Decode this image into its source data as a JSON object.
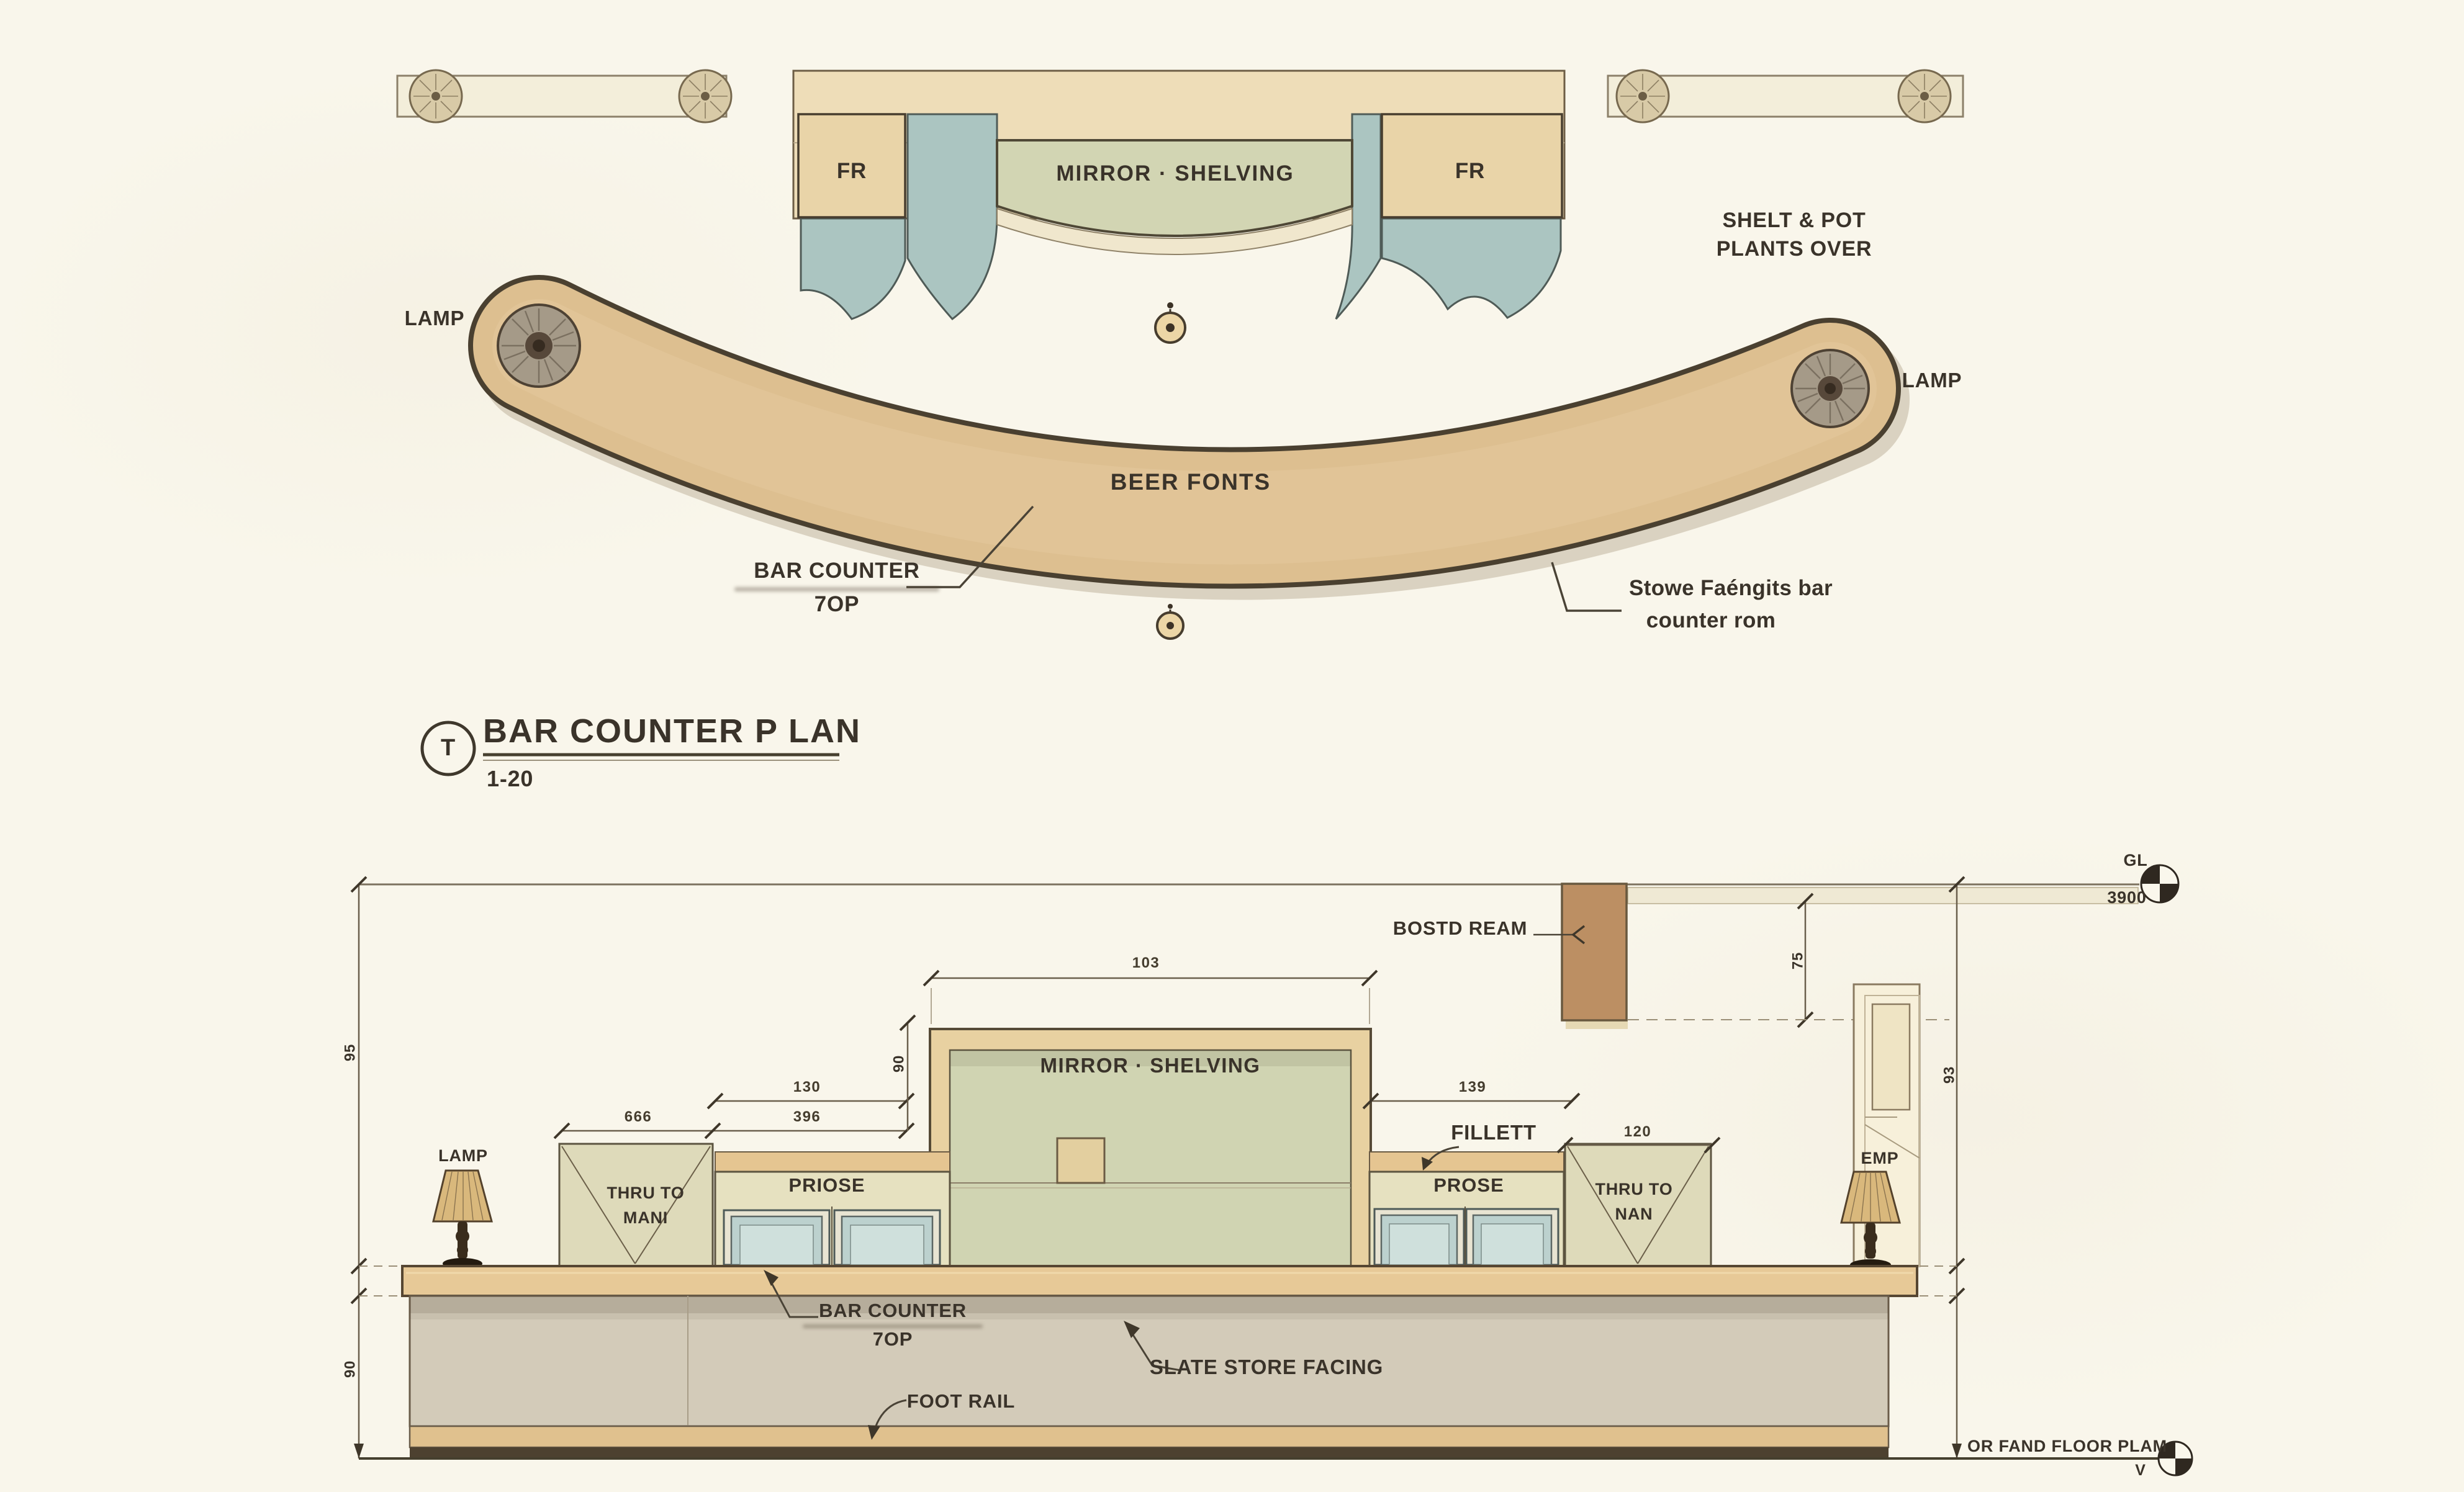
{
  "plan": {
    "fr_left": "FR",
    "fr_right": "FR",
    "mirror_shelving": "MIRROR · SHELVING",
    "shelf_note_line1": "SHELT & POT",
    "shelf_note_line2": "PLANTS OVER",
    "lamp_left": "LAMP",
    "lamp_right": "LAMP",
    "beer_fonts": "BEER FONTS",
    "counter_label_line1": "BAR COUNTER",
    "counter_label_line2": "7OP",
    "note_line1": "Stowe Faéngits bar",
    "note_line2": "counter rom",
    "title": {
      "marker": "T",
      "text": "BAR COUNTER P LAN",
      "scale": "1-20"
    }
  },
  "elevation": {
    "beam_label": "BOSTD REAM",
    "datum_top": {
      "label": "GL",
      "value": "3900"
    },
    "mirror_shelving": "MIRROR · SHELVING",
    "fillett": "FILLETT",
    "cabinet_left": "PRIOSE",
    "cabinet_right": "PROSE",
    "thru_left_line1": "THRU TO",
    "thru_left_line2": "MANI",
    "thru_right_line1": "THRU TO",
    "thru_right_line2": "NAN",
    "lamp_left": "LAMP",
    "lamp_right": "EMP",
    "counter_label_line1": "BAR COUNTER",
    "counter_label_line2": "7OP",
    "slate_label": "SLATE STORE FACING",
    "foot_rail_label": "FOOT RAIL",
    "floor_label": "OR FAND FLOOR PLAM",
    "floor_marker": "V",
    "dims": {
      "center_width": "103",
      "left_130": "130",
      "left_666": "666",
      "left_396": "396",
      "left_90": "90",
      "right_139": "139",
      "right_120": "120",
      "beam_75": "75",
      "right_93": "93",
      "side_upper": "95",
      "side_lower": "90"
    }
  },
  "colors": {
    "paper": "#f9f6eb",
    "counter_tan": "#ddbf90",
    "teal": "#abc5c1",
    "panel_green": "#d2d5b3",
    "beam_brown": "#bc8f63",
    "slate_front": "#d3cbb9",
    "ink": "#3a332a"
  }
}
